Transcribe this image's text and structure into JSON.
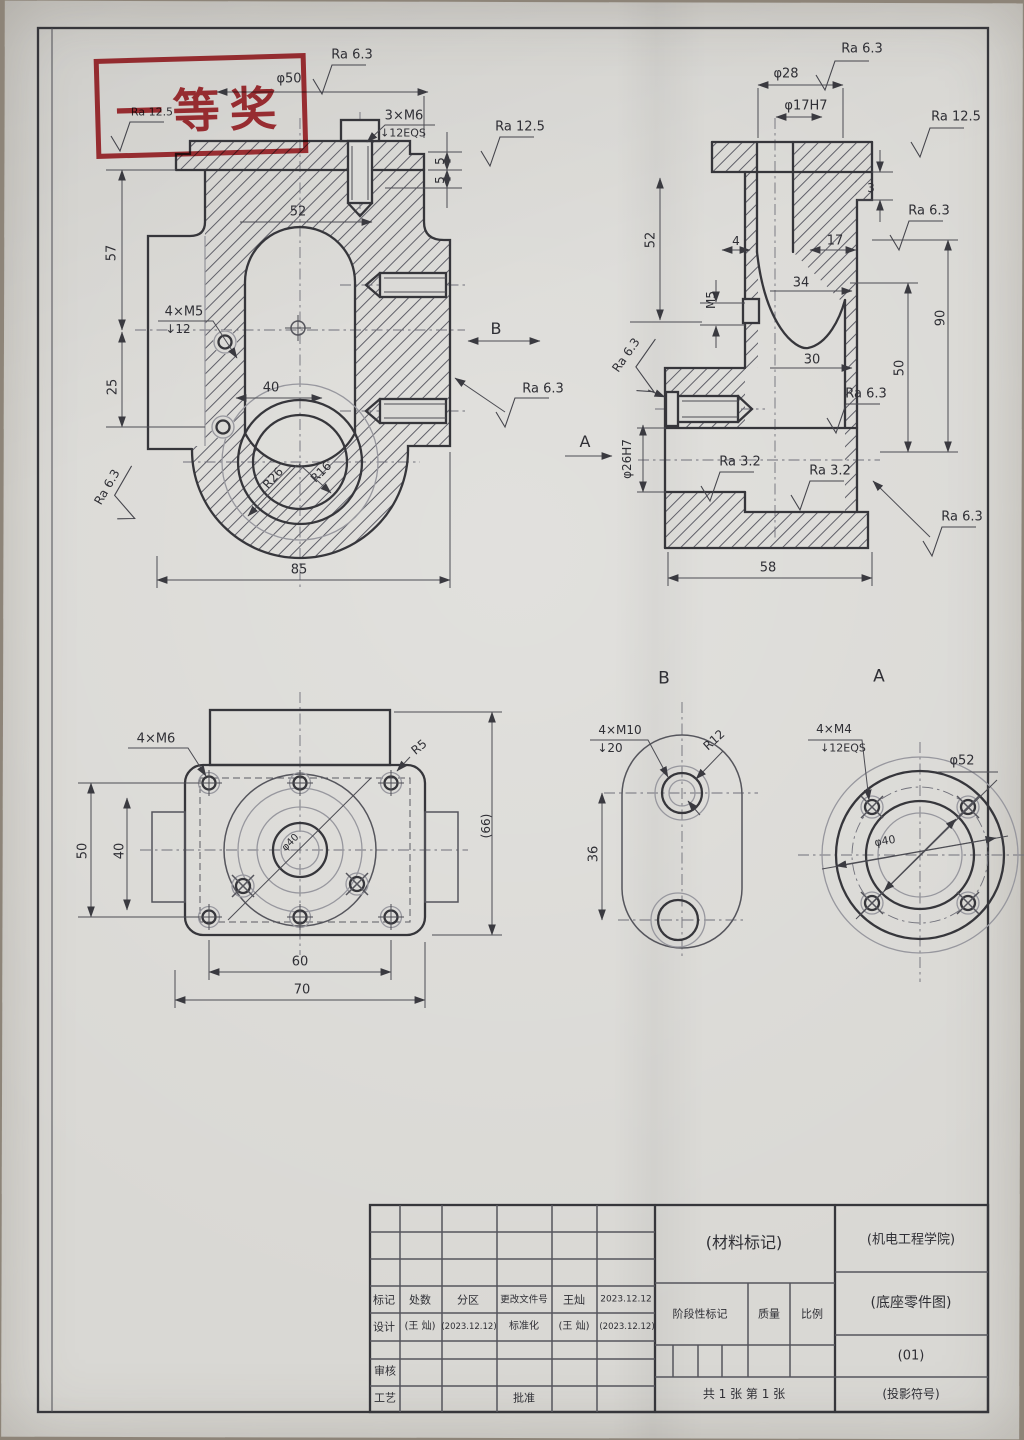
{
  "stamp": {
    "text": "一等奖"
  },
  "colors": {
    "paper": "#d9d8d4",
    "pencil": "#36363b",
    "stamp_red": "#b5353b"
  },
  "groups": {
    "front_view": [
      {
        "n": "ra-front-top",
        "t": "Ra 6.3",
        "x": 352,
        "y": 55,
        "r": 0,
        "s": 13
      },
      {
        "n": "dim-phi50",
        "t": "φ50",
        "x": 289,
        "y": 79,
        "r": 0,
        "s": 13
      },
      {
        "n": "ra-under-stamp",
        "t": "Ra 12.5",
        "x": 152,
        "y": 112,
        "r": 0,
        "s": 11
      },
      {
        "n": "dim-3xm6",
        "t": "3×M6",
        "x": 404,
        "y": 116,
        "r": 0,
        "s": 13
      },
      {
        "n": "dim-3xm6-depth",
        "t": "↓12EQS",
        "x": 403,
        "y": 133,
        "r": 0,
        "s": 11
      },
      {
        "n": "ra-flange-right",
        "t": "Ra 12.5",
        "x": 520,
        "y": 127,
        "r": 0,
        "s": 13
      },
      {
        "n": "dim-5-upper",
        "t": "5",
        "x": 440,
        "y": 161,
        "r": -90,
        "s": 12
      },
      {
        "n": "dim-5-lower",
        "t": "5",
        "x": 440,
        "y": 180,
        "r": -90,
        "s": 12
      },
      {
        "n": "dim-52-front",
        "t": "52",
        "x": 298,
        "y": 212,
        "r": 0,
        "s": 13
      },
      {
        "n": "dim-57",
        "t": "57",
        "x": 112,
        "y": 253,
        "r": -90,
        "s": 13
      },
      {
        "n": "dim-4xm5",
        "t": "4×M5",
        "x": 184,
        "y": 312,
        "r": 0,
        "s": 13
      },
      {
        "n": "dim-4xm5-depth",
        "t": "↓12",
        "x": 178,
        "y": 329,
        "r": 0,
        "s": 12
      },
      {
        "n": "dim-25",
        "t": "25",
        "x": 113,
        "y": 387,
        "r": -90,
        "s": 13
      },
      {
        "n": "dim-40-front",
        "t": "40",
        "x": 271,
        "y": 388,
        "r": 0,
        "s": 13
      },
      {
        "n": "view-b-arrow-label",
        "t": "B",
        "x": 496,
        "y": 329,
        "r": 0,
        "s": 16
      },
      {
        "n": "ra-wall-right",
        "t": "Ra 6.3",
        "x": 543,
        "y": 389,
        "r": 0,
        "s": 13
      },
      {
        "n": "ra-bottom-left",
        "t": "Ra 6.3",
        "x": 107,
        "y": 487,
        "r": -60,
        "s": 12
      },
      {
        "n": "dim-r26",
        "t": "R26",
        "x": 273,
        "y": 478,
        "r": -48,
        "s": 12
      },
      {
        "n": "dim-r16",
        "t": "R16",
        "x": 321,
        "y": 472,
        "r": -45,
        "s": 12
      },
      {
        "n": "dim-85",
        "t": "85",
        "x": 299,
        "y": 570,
        "r": 0,
        "s": 13
      }
    ],
    "side_view": [
      {
        "n": "ra-side-top",
        "t": "Ra 6.3",
        "x": 862,
        "y": 49,
        "r": 0,
        "s": 13
      },
      {
        "n": "dim-phi28",
        "t": "φ28",
        "x": 786,
        "y": 74,
        "r": 0,
        "s": 13
      },
      {
        "n": "dim-phi17h7",
        "t": "φ17H7",
        "x": 806,
        "y": 106,
        "r": 0,
        "s": 13
      },
      {
        "n": "ra-side-right-upper",
        "t": "Ra 12.5",
        "x": 956,
        "y": 117,
        "r": 0,
        "s": 13
      },
      {
        "n": "dim-3-step",
        "t": "3",
        "x": 871,
        "y": 188,
        "r": 0,
        "s": 12
      },
      {
        "n": "ra-side-right-2",
        "t": "Ra 6.3",
        "x": 929,
        "y": 211,
        "r": 0,
        "s": 13
      },
      {
        "n": "dim-52-side",
        "t": "52",
        "x": 651,
        "y": 240,
        "r": -90,
        "s": 13
      },
      {
        "n": "dim-4-side",
        "t": "4",
        "x": 736,
        "y": 241,
        "r": 0,
        "s": 12
      },
      {
        "n": "dim-17",
        "t": "17",
        "x": 835,
        "y": 241,
        "r": 0,
        "s": 13
      },
      {
        "n": "dim-34",
        "t": "34",
        "x": 801,
        "y": 283,
        "r": 0,
        "s": 13
      },
      {
        "n": "dim-m5",
        "t": "M5",
        "x": 711,
        "y": 300,
        "r": -90,
        "s": 12
      },
      {
        "n": "dim-90",
        "t": "90",
        "x": 941,
        "y": 318,
        "r": -90,
        "s": 13
      },
      {
        "n": "dim-30",
        "t": "30",
        "x": 812,
        "y": 360,
        "r": 0,
        "s": 13
      },
      {
        "n": "dim-50-side",
        "t": "50",
        "x": 900,
        "y": 368,
        "r": -90,
        "s": 13
      },
      {
        "n": "ra-side-left",
        "t": "Ra 6.3",
        "x": 626,
        "y": 355,
        "r": -55,
        "s": 12
      },
      {
        "n": "ra-side-mid",
        "t": "Ra 6.3",
        "x": 866,
        "y": 394,
        "r": 0,
        "s": 13
      },
      {
        "n": "view-a-arrow-label",
        "t": "A",
        "x": 585,
        "y": 442,
        "r": 0,
        "s": 16
      },
      {
        "n": "dim-phi26h7",
        "t": "φ26H7",
        "x": 627,
        "y": 459,
        "r": -90,
        "s": 12
      },
      {
        "n": "ra-base-1",
        "t": "Ra 3.2",
        "x": 740,
        "y": 462,
        "r": 0,
        "s": 13
      },
      {
        "n": "ra-base-2",
        "t": "Ra 3.2",
        "x": 830,
        "y": 471,
        "r": 0,
        "s": 13
      },
      {
        "n": "ra-base-right",
        "t": "Ra 6.3",
        "x": 962,
        "y": 517,
        "r": 0,
        "s": 13
      },
      {
        "n": "dim-58",
        "t": "58",
        "x": 768,
        "y": 568,
        "r": 0,
        "s": 13
      }
    ],
    "top_view": [
      {
        "n": "dim-4xm6-top",
        "t": "4×M6",
        "x": 156,
        "y": 739,
        "r": 0,
        "s": 13
      },
      {
        "n": "dim-r5",
        "t": "R5",
        "x": 419,
        "y": 747,
        "r": -40,
        "s": 12
      },
      {
        "n": "dim-66",
        "t": "(66)",
        "x": 486,
        "y": 826,
        "r": -90,
        "s": 12
      },
      {
        "n": "dim-50-top",
        "t": "50",
        "x": 83,
        "y": 851,
        "r": -90,
        "s": 13
      },
      {
        "n": "dim-40-top",
        "t": "40",
        "x": 120,
        "y": 851,
        "r": -90,
        "s": 13
      },
      {
        "n": "dim-phi40-top",
        "t": "φ40",
        "x": 291,
        "y": 843,
        "r": -45,
        "s": 10
      },
      {
        "n": "dim-60",
        "t": "60",
        "x": 300,
        "y": 962,
        "r": 0,
        "s": 13
      },
      {
        "n": "dim-70",
        "t": "70",
        "x": 302,
        "y": 990,
        "r": 0,
        "s": 13
      }
    ],
    "view_b": [
      {
        "n": "view-b-title",
        "t": "B",
        "x": 664,
        "y": 679,
        "r": 0,
        "s": 17
      },
      {
        "n": "dim-4xm10",
        "t": "4×M10",
        "x": 620,
        "y": 730,
        "r": 0,
        "s": 12
      },
      {
        "n": "dim-4xm10-depth",
        "t": "↓20",
        "x": 610,
        "y": 748,
        "r": 0,
        "s": 12
      },
      {
        "n": "dim-r12",
        "t": "R12",
        "x": 714,
        "y": 740,
        "r": -42,
        "s": 12
      },
      {
        "n": "dim-36",
        "t": "36",
        "x": 594,
        "y": 854,
        "r": -90,
        "s": 13
      }
    ],
    "view_a": [
      {
        "n": "view-a-title",
        "t": "A",
        "x": 879,
        "y": 677,
        "r": 0,
        "s": 17
      },
      {
        "n": "dim-4xm4",
        "t": "4×M4",
        "x": 834,
        "y": 729,
        "r": 0,
        "s": 12
      },
      {
        "n": "dim-4xm4-depth",
        "t": "↓12EQS",
        "x": 843,
        "y": 748,
        "r": 0,
        "s": 11
      },
      {
        "n": "dim-phi52",
        "t": "φ52",
        "x": 962,
        "y": 761,
        "r": 0,
        "s": 13
      },
      {
        "n": "dim-phi40-a",
        "t": "φ40",
        "x": 885,
        "y": 841,
        "r": -10,
        "s": 11
      }
    ],
    "title_block": [
      {
        "n": "tb-material-mark",
        "t": "(材料标记)",
        "x": 744,
        "y": 1243,
        "r": 0,
        "s": 16
      },
      {
        "n": "tb-school",
        "t": "(机电工程学院)",
        "x": 911,
        "y": 1240,
        "r": 0,
        "s": 13
      },
      {
        "n": "tb-biaoji",
        "t": "标记",
        "x": 384,
        "y": 1300,
        "r": 0,
        "s": 11
      },
      {
        "n": "tb-chushu",
        "t": "处数",
        "x": 420,
        "y": 1300,
        "r": 0,
        "s": 11
      },
      {
        "n": "tb-fenqu",
        "t": "分区",
        "x": 468,
        "y": 1300,
        "r": 0,
        "s": 11
      },
      {
        "n": "tb-genggai",
        "t": "更改文件号",
        "x": 524,
        "y": 1300,
        "r": 0,
        "s": 9.5
      },
      {
        "n": "tb-qianming",
        "t": "王灿",
        "x": 574,
        "y": 1300,
        "r": 0,
        "s": 11
      },
      {
        "n": "tb-riqi",
        "t": "2023.12.12",
        "x": 626,
        "y": 1300,
        "r": 0,
        "s": 9
      },
      {
        "n": "tb-sheji",
        "t": "设计",
        "x": 384,
        "y": 1327,
        "r": 0,
        "s": 11
      },
      {
        "n": "tb-sheji-name",
        "t": "(王 灿)",
        "x": 420,
        "y": 1327,
        "r": 0,
        "s": 10
      },
      {
        "n": "tb-sheji-date",
        "t": "(2023.12.12)",
        "x": 469,
        "y": 1327,
        "r": 0,
        "s": 8.5
      },
      {
        "n": "tb-biaozhunhua",
        "t": "标准化",
        "x": 524,
        "y": 1327,
        "r": 0,
        "s": 10
      },
      {
        "n": "tb-bzh-name",
        "t": "(王 灿)",
        "x": 574,
        "y": 1327,
        "r": 0,
        "s": 10
      },
      {
        "n": "tb-bzh-date",
        "t": "(2023.12.12)",
        "x": 627,
        "y": 1327,
        "r": 0,
        "s": 8.5
      },
      {
        "n": "tb-shenhe",
        "t": "审核",
        "x": 385,
        "y": 1371,
        "r": 0,
        "s": 11
      },
      {
        "n": "tb-gongyi",
        "t": "工艺",
        "x": 385,
        "y": 1398,
        "r": 0,
        "s": 11
      },
      {
        "n": "tb-pizhun",
        "t": "批准",
        "x": 524,
        "y": 1398,
        "r": 0,
        "s": 11
      },
      {
        "n": "tb-stage-mark",
        "t": "阶段性标记",
        "x": 700,
        "y": 1314,
        "r": 0,
        "s": 11
      },
      {
        "n": "tb-zhiliang",
        "t": "质量",
        "x": 769,
        "y": 1314,
        "r": 0,
        "s": 11
      },
      {
        "n": "tb-bili",
        "t": "比例",
        "x": 812,
        "y": 1314,
        "r": 0,
        "s": 11
      },
      {
        "n": "tb-sheets",
        "t": "共 1 张 第 1 张",
        "x": 744,
        "y": 1394,
        "r": 0,
        "s": 12
      },
      {
        "n": "tb-drawing-name",
        "t": "(底座零件图)",
        "x": 911,
        "y": 1303,
        "r": 0,
        "s": 14
      },
      {
        "n": "tb-drawing-no",
        "t": "(01)",
        "x": 911,
        "y": 1356,
        "r": 0,
        "s": 13
      },
      {
        "n": "tb-projection",
        "t": "(投影符号)",
        "x": 911,
        "y": 1394,
        "r": 0,
        "s": 12
      }
    ]
  }
}
